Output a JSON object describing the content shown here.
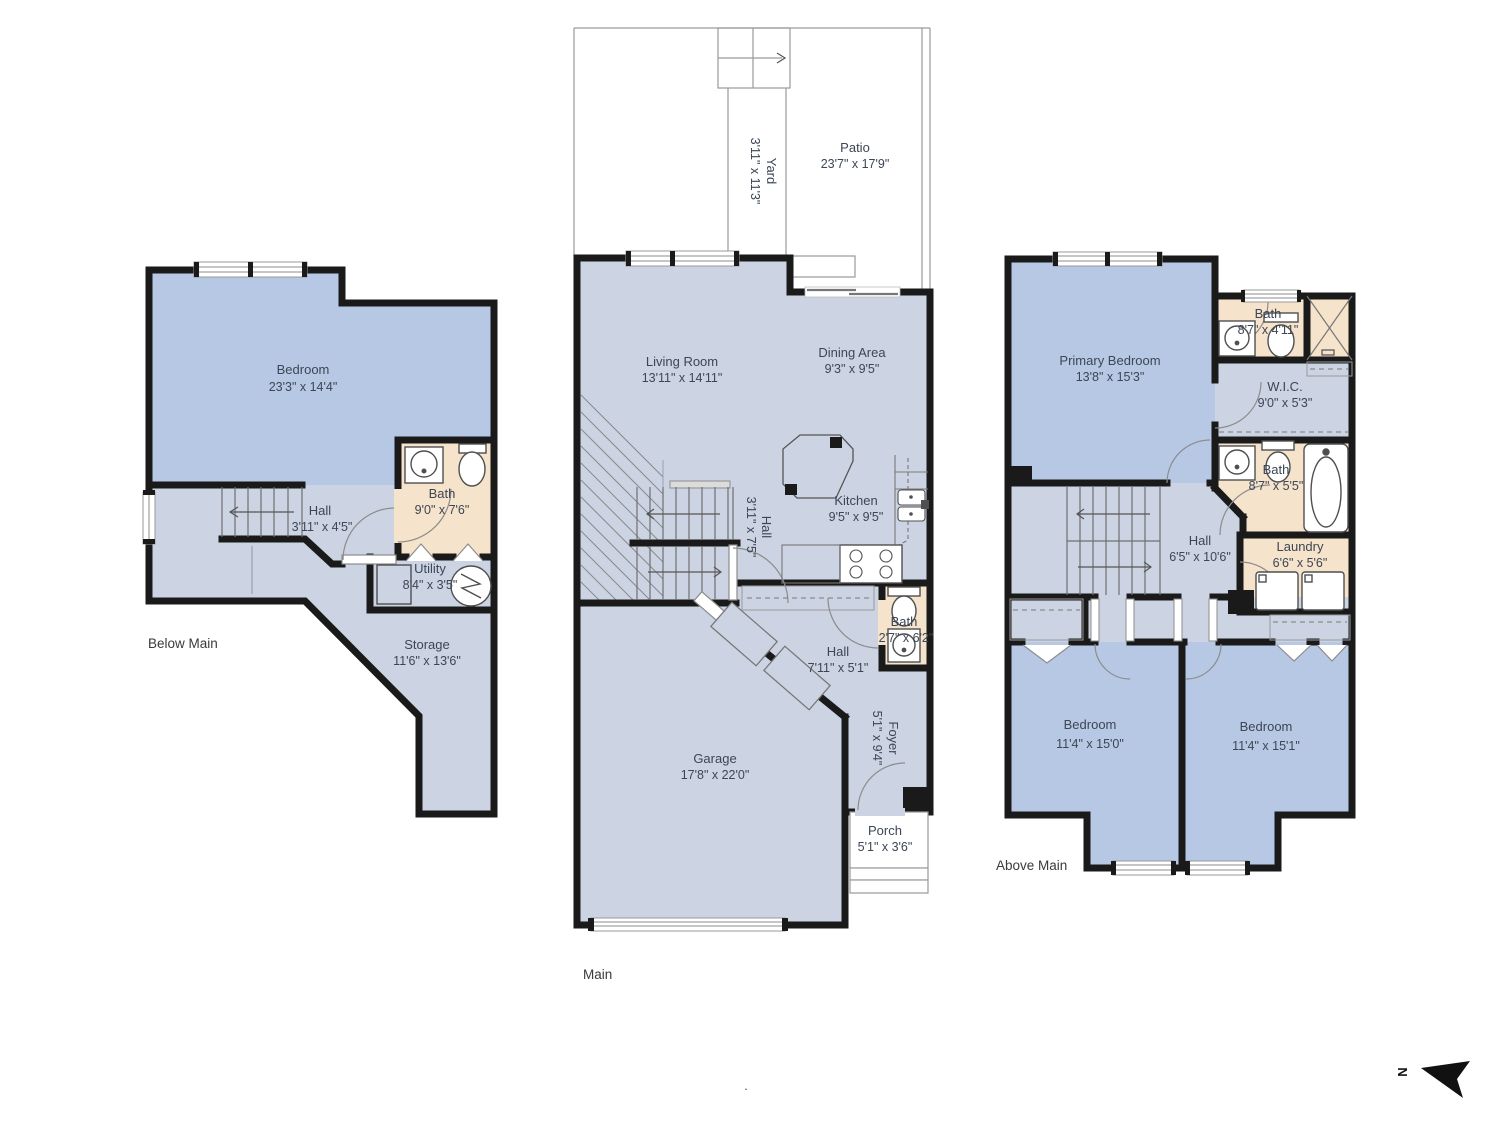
{
  "colors": {
    "wall": "#1a1a1a",
    "room_blue": "#b7c8e5",
    "room_light": "#ccd4e3",
    "room_peach": "#f6e3cb",
    "outdoor": "#ffffff",
    "line": "#8c8c8c",
    "text": "#3c4654"
  },
  "floors": {
    "below": {
      "label": "Below Main",
      "rooms": {
        "bedroom": {
          "name": "Bedroom",
          "dims": "23'3\" x 14'4\""
        },
        "bath": {
          "name": "Bath",
          "dims": "9'0\" x 7'6\""
        },
        "hall": {
          "name": "Hall",
          "dims": "3'11\" x 4'5\""
        },
        "utility": {
          "name": "Utility",
          "dims": "8'4\" x 3'5\""
        },
        "storage": {
          "name": "Storage",
          "dims": "11'6\" x 13'6\""
        }
      }
    },
    "main": {
      "label": "Main",
      "rooms": {
        "yard": {
          "name": "Yard",
          "dims": "3'11\" x 11'3\""
        },
        "patio": {
          "name": "Patio",
          "dims": "23'7\" x 17'9\""
        },
        "living_room": {
          "name": "Living Room",
          "dims": "13'11\" x 14'11\""
        },
        "dining_area": {
          "name": "Dining Area",
          "dims": "9'3\" x 9'5\""
        },
        "kitchen": {
          "name": "Kitchen",
          "dims": "9'5\" x 9'5\""
        },
        "hall_upper": {
          "name": "Hall",
          "dims": "3'11\" x 7'5\""
        },
        "hall_lower": {
          "name": "Hall",
          "dims": "7'11\" x 5'1\""
        },
        "bath": {
          "name": "Bath",
          "dims": "2'7\" x 6'2\""
        },
        "garage": {
          "name": "Garage",
          "dims": "17'8\" x 22'0\""
        },
        "foyer": {
          "name": "Foyer",
          "dims": "5'1\" x 9'4\""
        },
        "porch": {
          "name": "Porch",
          "dims": "5'1\" x 3'6\""
        }
      }
    },
    "above": {
      "label": "Above Main",
      "rooms": {
        "primary_bedroom": {
          "name": "Primary Bedroom",
          "dims": "13'8\" x 15'3\""
        },
        "bath_top": {
          "name": "Bath",
          "dims": "8'7\" x 4'11\""
        },
        "wic": {
          "name": "W.I.C.",
          "dims": "9'0\" x 5'3\""
        },
        "bath_mid": {
          "name": "Bath",
          "dims": "8'7\" x 5'5\""
        },
        "laundry": {
          "name": "Laundry",
          "dims": "6'6\" x 5'6\""
        },
        "hall": {
          "name": "Hall",
          "dims": "6'5\" x 10'6\""
        },
        "bedroom_left": {
          "name": "Bedroom",
          "dims": "11'4\" x 15'0\""
        },
        "bedroom_right": {
          "name": "Bedroom",
          "dims": "11'4\" x 15'1\""
        }
      }
    }
  },
  "compass": {
    "label": "N"
  },
  "footnote": "."
}
